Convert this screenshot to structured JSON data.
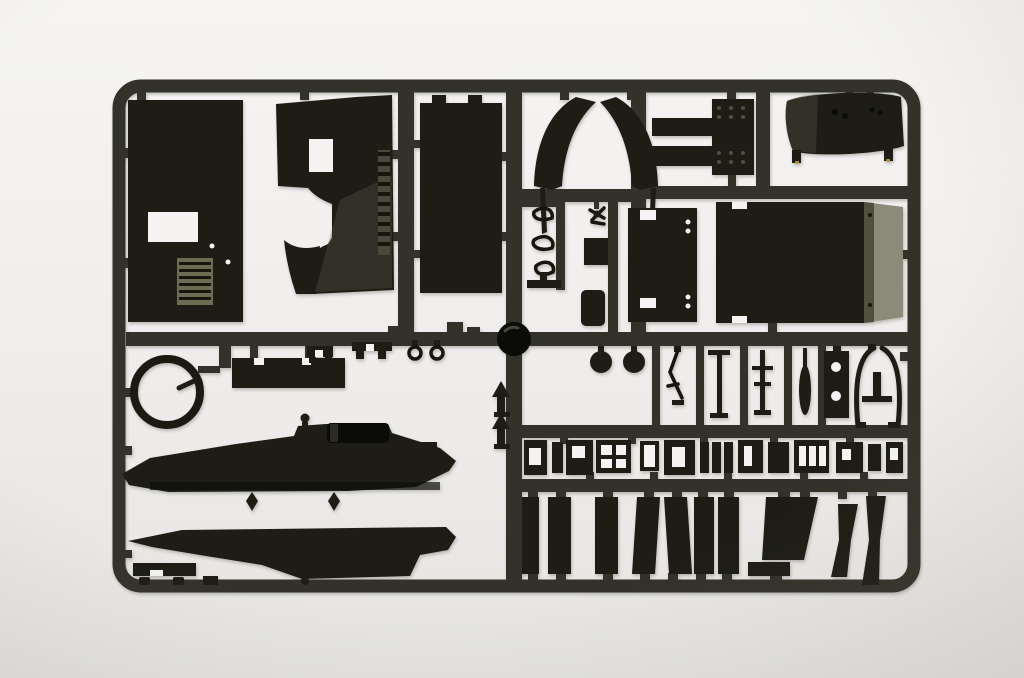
{
  "photo": {
    "subject": "dark olive injection-molded model kit sprue with unassembled parts",
    "orientation": "landscape"
  },
  "colors": {
    "background_top": "#f6f5f3",
    "background_bottom": "#e5e4e1",
    "sprue": "#32322a",
    "part_dark": "#1d1d16",
    "part_deep": "#0b0b07",
    "sheen_light": "#8b8b79",
    "sheen_mid": "#50503e",
    "olive_detail": "#6c6c52",
    "cutout": "#f4f3f1",
    "accent_yellow": "#b7a14b"
  },
  "parts": [
    "hatch-panel",
    "angled-side-plate",
    "tall-side-panel",
    "wheel-arch-pair",
    "spring-hooks-set",
    "small-clamp",
    "square-plate",
    "rounded-block",
    "stepped-bracket",
    "riveted-plate",
    "curved-fender",
    "riveted-panel",
    "equipment-box",
    "turret-ring",
    "notched-strip",
    "small-clips",
    "wire-hooks",
    "hull-side-upper",
    "hull-side-lower",
    "foot-bracket",
    "round-hub",
    "shift-levers",
    "road-wheels",
    "thin-rod",
    "t-lever",
    "cross-lever",
    "oar-blade",
    "holed-bracket",
    "frame-arch",
    "fittings-row",
    "window-frame",
    "track-guard-planks",
    "mud-flaps"
  ]
}
